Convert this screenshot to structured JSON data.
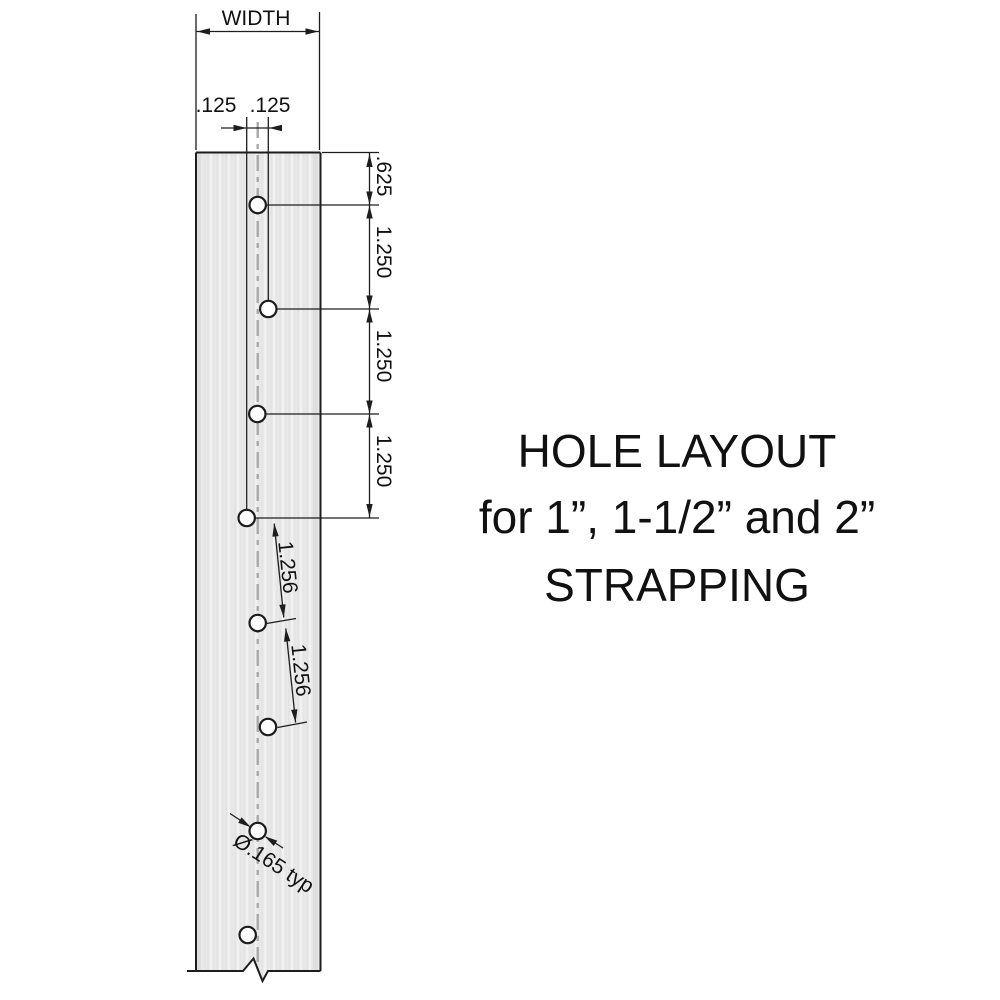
{
  "title": {
    "line1": "HOLE LAYOUT",
    "line2": "for 1”, 1-1/2” and 2”",
    "line3": "STRAPPING"
  },
  "dimensions": {
    "width": "WIDTH",
    "offset_left": ".125",
    "offset_right": ".125",
    "first_hole": ".625",
    "pitch1": "1.250",
    "pitch2": "1.250",
    "pitch3": "1.250",
    "stagger1": "1.256",
    "stagger2": "1.256",
    "hole_diameter": "Ø.165 typ"
  },
  "holes": [
    {
      "cx": 257.7,
      "cy": 205
    },
    {
      "cx": 268.3,
      "cy": 309
    },
    {
      "cx": 257.3,
      "cy": 414
    },
    {
      "cx": 246.7,
      "cy": 518
    },
    {
      "cx": 257.7,
      "cy": 623
    },
    {
      "cx": 268.0,
      "cy": 727
    },
    {
      "cx": 257.7,
      "cy": 831
    },
    {
      "cx": 247.7,
      "cy": 935
    }
  ],
  "hole_radius": 8.2,
  "colors": {
    "background": "#ffffff",
    "strip_fill": "#e9e9e9",
    "line": "#1d1d1d",
    "centerline": "#a9a9a9",
    "text": "#111111"
  }
}
